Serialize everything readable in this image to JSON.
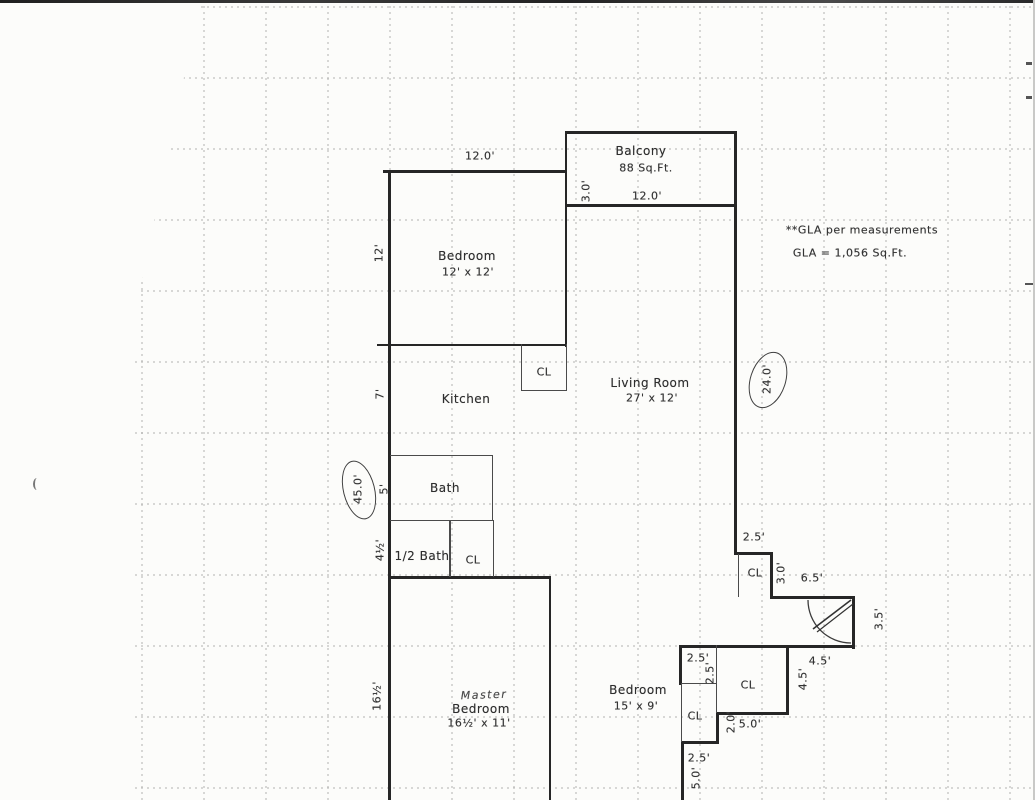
{
  "plan": {
    "gla_note": "**GLA per measurements",
    "gla_value": "GLA = 1,056 Sq.Ft.",
    "balcony": {
      "name": "Balcony",
      "area": "88 Sq.Ft.",
      "width": "12.0'",
      "depth": "3.0'"
    },
    "bedroom_top": {
      "name": "Bedroom",
      "size": "12' x 12'",
      "width_dim": "12.0'",
      "left_dim": "12'"
    },
    "kitchen": {
      "name": "Kitchen",
      "left_dim": "7'",
      "closet": "CL"
    },
    "living_room": {
      "name": "Living Room",
      "size": "27' x 12'",
      "right_dim": "24.0'"
    },
    "bath": {
      "name": "Bath",
      "left_dim": "5'"
    },
    "half_bath": {
      "name": "1/2 Bath",
      "left_dim": "4½'",
      "closet": "CL"
    },
    "left_overall_dim": "45.0'",
    "entry": {
      "jog_width": "2.5'",
      "closet": "CL",
      "closet_depth": "3.0'",
      "hall_width": "6.5'",
      "door_dim": "3.5'",
      "dim_a": "4.5'",
      "dim_b": "4.5'"
    },
    "bedroom_right": {
      "name": "Bedroom",
      "size": "15' x 9'",
      "nook_w": "2.5'",
      "nook_h": "2.5'",
      "closet": "CL",
      "closet_small": "CL",
      "step_h": "2.0'",
      "closet_width": "5.0'",
      "lower_w": "2.5'",
      "lower_h": "5.0'"
    },
    "master_bedroom": {
      "hand_note": "Master",
      "name": "Bedroom",
      "size": "16½' x 11'",
      "left_dim": "16½'"
    }
  }
}
